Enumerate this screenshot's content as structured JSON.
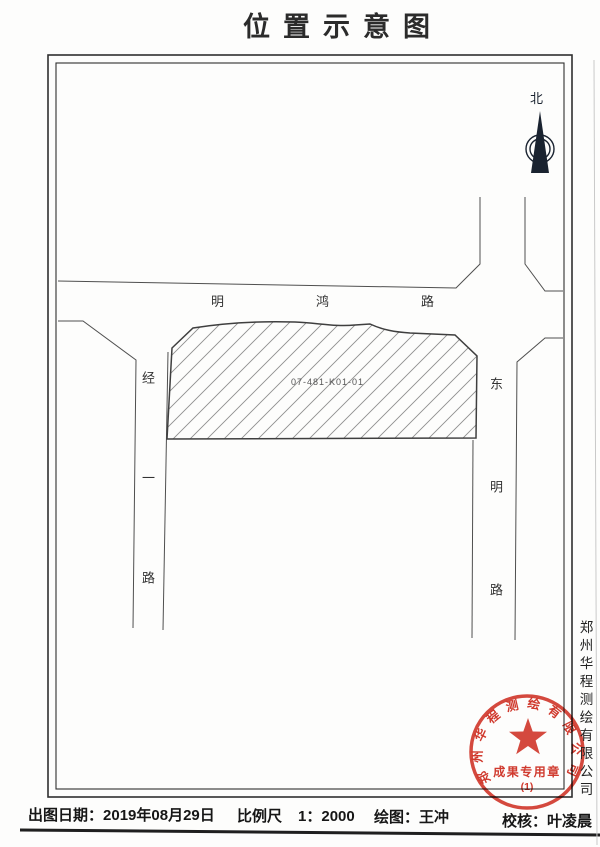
{
  "title": "位置示意图",
  "north": {
    "label": "北"
  },
  "map": {
    "parcel_code": "07-481-K01-01",
    "road_horizontal": "明鸿路",
    "road_left": "经一路",
    "road_right": "东明路"
  },
  "company_vertical": "郑州华程测绘有限公司",
  "seal": {
    "company_arc": "郑州华程测绘有限公司",
    "title": "成果专用章",
    "number": "(1)"
  },
  "footer": {
    "date_label": "出图日期：",
    "date_value": "2019年08月29日",
    "scale_label": "比例尺",
    "scale_value": "1：2000",
    "drafter_label": "绘图：",
    "drafter_value": "王冲",
    "checker_label": "校核：",
    "checker_value": "叶凌晨"
  },
  "colors": {
    "seal_red": "#d23a2e",
    "line_gray": "#4f4f4f",
    "frame_black": "#2f2f2f"
  }
}
